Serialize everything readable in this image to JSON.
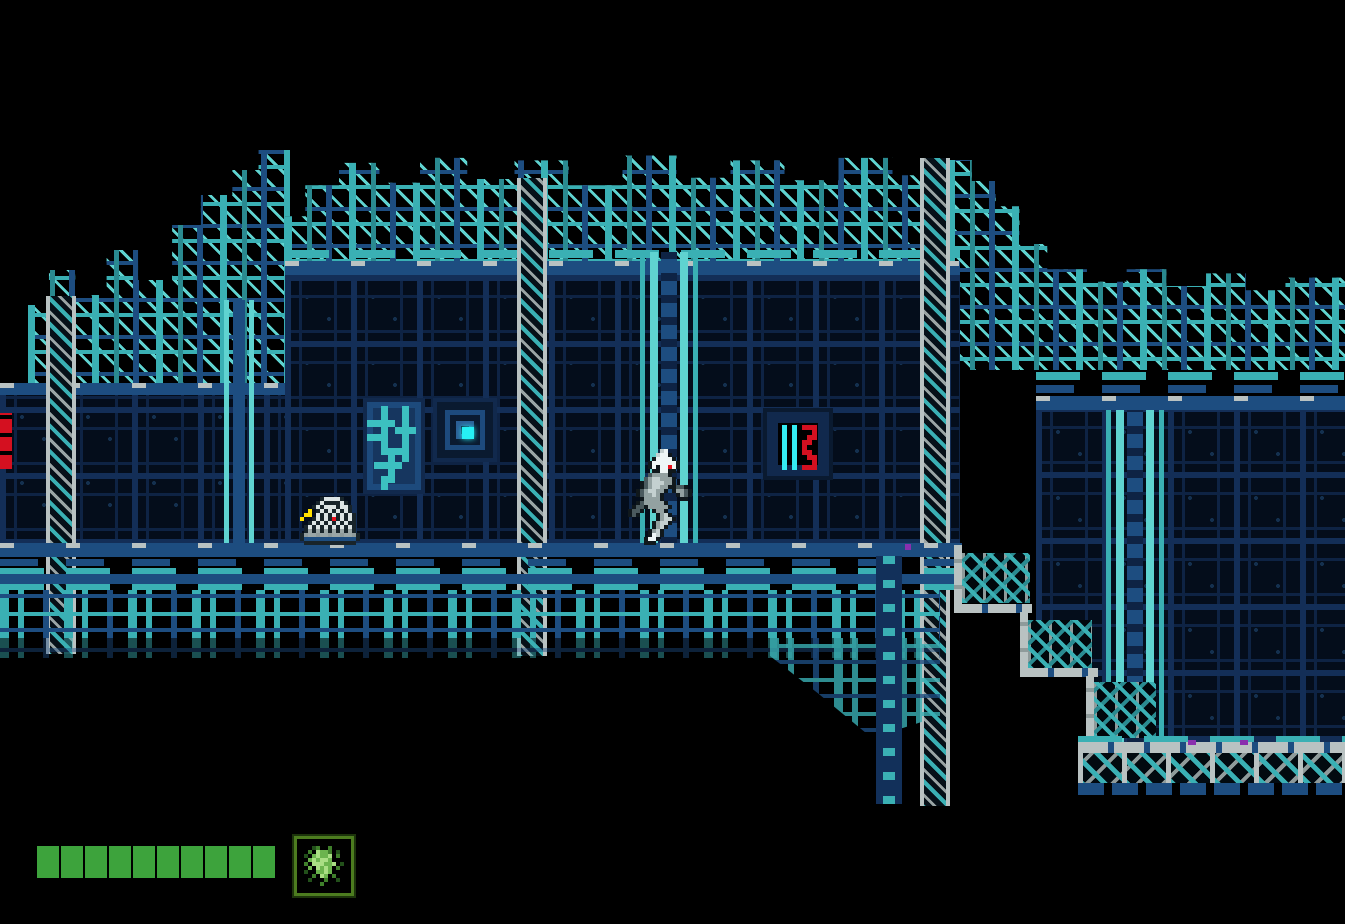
{
  "meta": {
    "description": "Retro 8-bit side-scrolling action game screenshot: cyborg ninja running right along a metal platform inside a dark teal industrial fortress at night",
    "visible_text": "none"
  },
  "palette": {
    "background": "#000000",
    "panel_interior": "#040d1b",
    "grout_navy": "#132e57",
    "navy_mid": "#1d4d80",
    "teal": "#3ab0b4",
    "teal_light": "#5fd3d0",
    "cyan_bright": "#26f0f4",
    "gray_light": "#b9c2c2",
    "gray_mid": "#8f9b9b",
    "red": "#d41020",
    "hud_green": "#3da33c",
    "purple_accent": "#8a2fae",
    "turret_barrel_yellow": "#ffe000"
  },
  "hud": {
    "health_bar": {
      "segments_total": 10,
      "segments_filled": 10,
      "fill_color": "#3da33c"
    },
    "item_slot": {
      "frame_color": "#4c7c1f",
      "icon": "green-energy-item"
    }
  },
  "sprites": {
    "player": {
      "label": "cyborg-ninja-running-right",
      "scale": 4,
      "palette": {
        "K": "#10181c",
        "D": "#4b5a5e",
        "M": "#93a1a1",
        "L": "#c4d0d0",
        "W": "#eef6f6",
        "R": "#e8101c"
      },
      "rows": [
        "........LW........",
        ".......LWWK.......",
        "......KWWWWK......",
        ".....KWWWWWWK.....",
        ".....KWKWWRWK.....",
        "......KKWWKK......",
        ".....DMMMMK.......",
        "....DMLLMMMK......",
        "...KDMLLLMMK......",
        "...KDMLLMMKKDDK...",
        "..KDMLLMMK.KMMDK..",
        "..KDMMLMK...KMDK..",
        "...KMMMMK....KK...",
        "..KDMMMMMK........",
        ".KDDKMMMMMK.......",
        "KDDK..KMMK........",
        "KDK....KMLK.......",
        ".......KMLLK......",
        "......KMLLK.......",
        "......KMLK........",
        ".....KMLK.........",
        ".....KWLK.........",
        "....KWWK..........",
        "....KKK..........."
      ]
    },
    "turret": {
      "label": "caged-wall-turret-with-yellow-barrel",
      "scale": 4,
      "palette": {
        "K": "#18242a",
        "W": "#dce4e4",
        "M": "#9aa6a6",
        "Y": "#ffe000",
        "R": "#e8101c",
        "N": "#1d4d80",
        "G": "#8f9b9b"
      },
      "rows": [
        ".....KWWWWK.....",
        "....KWKKKKWK....",
        "...KWKWWWKWWK...",
        "..Y.KWKWKWKWK...",
        ".YY.WKWKWKWKWK..",
        "Y..KWKWKRKWKWK..",
        "..KWKWKWKWKWKK..",
        ".KWKWKWKWKWKWK..",
        ".KMKMKMKMKMKMK..",
        "KGMMGMMGMMGMMGK.",
        "KNNNNNNNNNNNNNK.",
        ".KKKKKKKKKKKKK.."
      ]
    },
    "item": {
      "label": "green-energy-item-icon",
      "scale": 4,
      "palette": {
        "a": "#aade84",
        "b": "#6cb44e",
        "c": "#3f7f2b",
        "d": "#22501a"
      },
      "rows": [
        "............",
        "...dc..c....",
        "..c.abbc.d..",
        ".d.babba.c..",
        "..babaab....",
        ".c.aaabba.d.",
        "..b.abab.c..",
        ".d..bbab....",
        "...c.ab.c...",
        "..d...c..d..",
        ".....c......",
        "............"
      ]
    },
    "red_screen": {
      "label": "status-readout-cyan-bars-red-glyph",
      "scale": 5,
      "palette": {
        "C": "#35ecf2",
        "R": "#d41020"
      },
      "rows": [
        "C.C.RRR.",
        "C.C...R.",
        "C.C..RR.",
        "C.C.RR..",
        "C.C.R...",
        "C.C.RR..",
        "C.C..RR.",
        "C.C...R.",
        "C.C.RRR."
      ]
    },
    "pipes": {
      "label": "teal-conduit-pipes",
      "scale": 7,
      "palette": {
        "T": "#3cc0c0"
      },
      "rows": [
        "....T..T....",
        "....T..T....",
        "..TTTT.T....",
        "....T.TTT...",
        "..TTT..T....",
        "....T..T....",
        "....TTTT....",
        ".....T.T....",
        "...TTTT.....",
        ".....T......",
        "....TT......",
        "....T......."
      ]
    }
  }
}
